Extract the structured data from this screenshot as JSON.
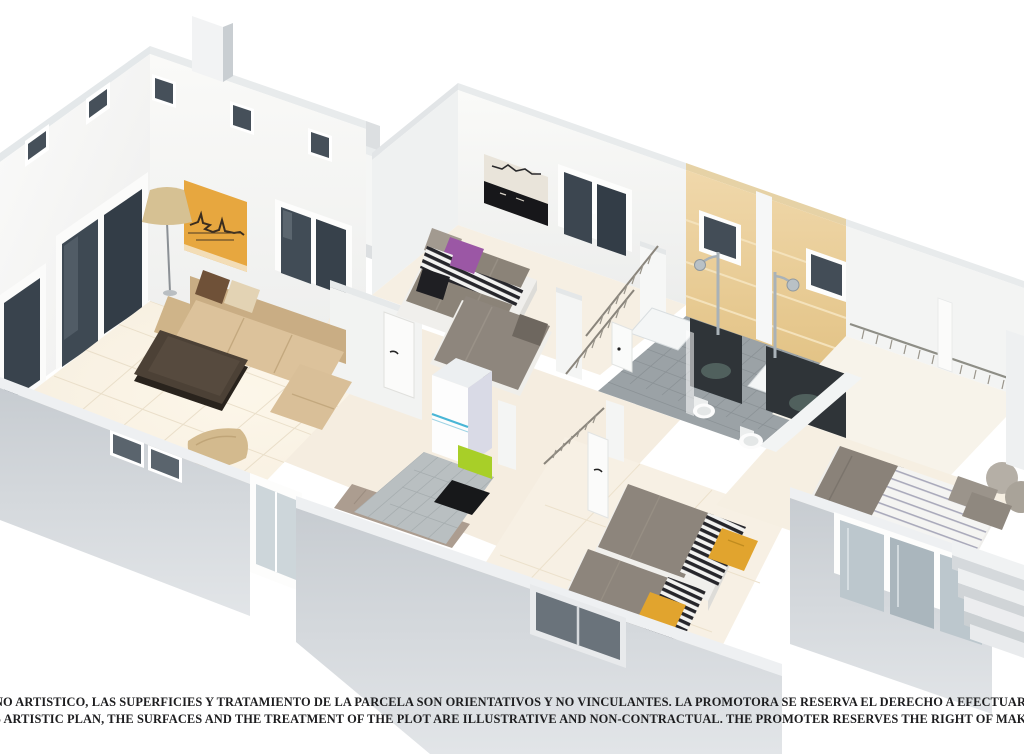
{
  "disclaimer": {
    "line1": "NO ARTISTICO, LAS SUPERFICIES Y TRATAMIENTO DE LA PARCELA SON ORIENTATIVOS Y NO VINCULANTES. LA PROMOTORA SE RESERVA EL DERECHO A EFECTUAR MODIFICACIONES POR CUALQUIER N",
    "line2": "S ARTISTIC PLAN, THE SURFACES AND THE TREATMENT OF THE PLOT ARE ILLUSTRATIVE AND NON-CONTRACTUAL. THE PROMOTER RESERVES THE RIGHT OF MAKING CHANGES DUE TO ANY NECESSITY"
  },
  "palette": {
    "background": "#ffffff",
    "wall_white": "#f6f7f6",
    "wall_shadow": "#e3e6e8",
    "outer_wall_gray": "#ccd1d5",
    "floor_cream": "#f6eedf",
    "bath_wall_sand": "#ecd2a1",
    "bath_floor_gray": "#9ba2a6",
    "kitchen_tile_gray": "#b9bfc1",
    "glass_dark": "#414c56",
    "sofa_beige": "#d9bf98",
    "table_brown": "#4c4136",
    "artwork_orange": "#e7a73f",
    "duvet_gray": "#8d857c",
    "pillow_purple": "#9b57a5",
    "pillow_mustard": "#e1a42e",
    "accent_lime": "#a8cf28",
    "accent_blue": "#49b6d6",
    "stripe_black": "#26262b",
    "text_color": "#1d1d1f"
  }
}
